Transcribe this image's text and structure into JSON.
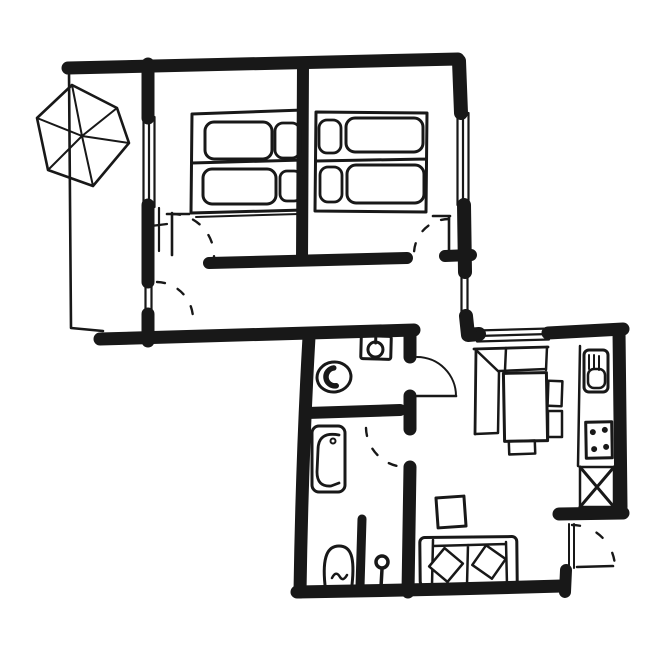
{
  "canvas": {
    "width": 671,
    "height": 660
  },
  "colors": {
    "ink": "#181818",
    "paper": "#ffffff"
  },
  "drawing": {
    "kind": "hand-drawn-apartment-floor-plan",
    "rooms": [
      {
        "id": "balcony",
        "fixtures": [
          "parasol"
        ]
      },
      {
        "id": "bedroom-1",
        "fixtures": [
          "double-bed",
          "pillows",
          "duvets",
          "window",
          "door",
          "radiator"
        ]
      },
      {
        "id": "bedroom-2",
        "fixtures": [
          "double-bed",
          "pillows",
          "duvets",
          "window",
          "door"
        ]
      },
      {
        "id": "hall",
        "fixtures": [
          "balcony-door",
          "window"
        ]
      },
      {
        "id": "wc",
        "fixtures": [
          "toilet",
          "washbasin",
          "door"
        ]
      },
      {
        "id": "bathroom",
        "fixtures": [
          "bathtub",
          "toilet",
          "washstand",
          "partition",
          "door"
        ]
      },
      {
        "id": "kitchen",
        "fixtures": [
          "window",
          "sink",
          "stove",
          "crossed-cabinet",
          "corner-bench",
          "dining-table",
          "chairs"
        ]
      },
      {
        "id": "living-room",
        "fixtures": [
          "sofa",
          "cushions",
          "side-table",
          "entrance-door"
        ]
      }
    ]
  }
}
